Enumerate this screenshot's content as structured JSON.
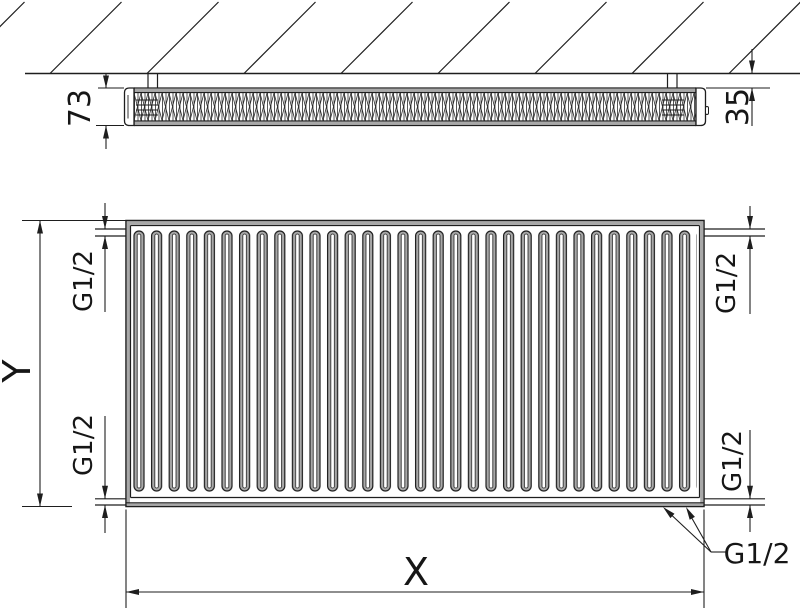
{
  "drawing": {
    "type": "radiator technical dimension drawing",
    "line_color": "#1e1e1e",
    "shade_color": "#a8a8a8",
    "background": "#ffffff",
    "top_view": {
      "depth": "73",
      "wall_distance": "35"
    },
    "front_view": {
      "height": "Y",
      "width": "X",
      "thread_top_left": "G1/2",
      "thread_bottom_left": "G1/2",
      "thread_top_right": "G1/2",
      "thread_bottom_right": "G1/2",
      "thread_bottom_connections": "G1/2"
    }
  }
}
